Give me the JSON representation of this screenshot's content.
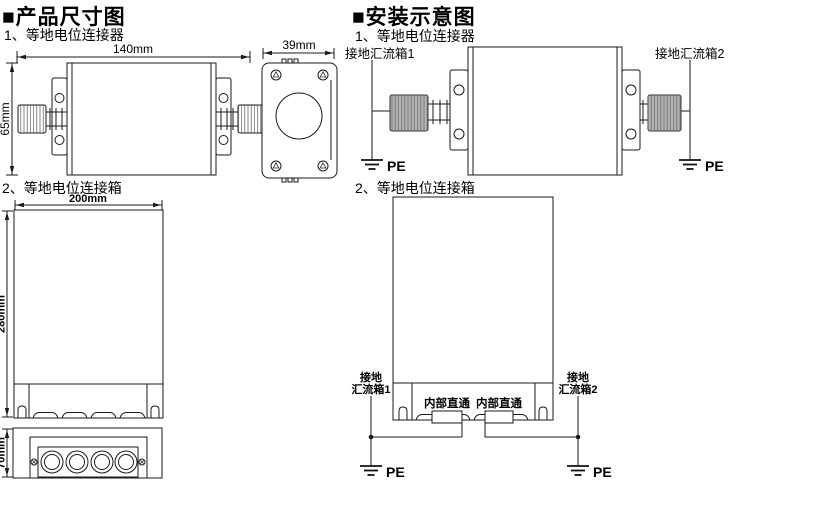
{
  "titles": {
    "left": "■产品尺寸图",
    "right": "■安装示意图"
  },
  "colors": {
    "line": "#1a1a1a",
    "knob_fill": "#b5b5b5",
    "background": "#ffffff"
  },
  "left": {
    "s1_label": "1、等地电位连接器",
    "s2_label": "2、等地电位连接箱",
    "dims": {
      "w140": "140mm",
      "h65": "65mm",
      "w39": "39mm",
      "w200": "200mm",
      "h280": "280mm",
      "h70": "70mm"
    }
  },
  "right": {
    "s1_label": "1、等地电位连接器",
    "s2_label": "2、等地电位连接箱",
    "bus1": "接地汇流箱1",
    "bus2": "接地汇流箱2",
    "bus1_l1": "接地",
    "bus1_l2": "汇流箱1",
    "bus2_l1": "接地",
    "bus2_l2": "汇流箱2",
    "jumper": "内部直通",
    "pe": "PE"
  }
}
